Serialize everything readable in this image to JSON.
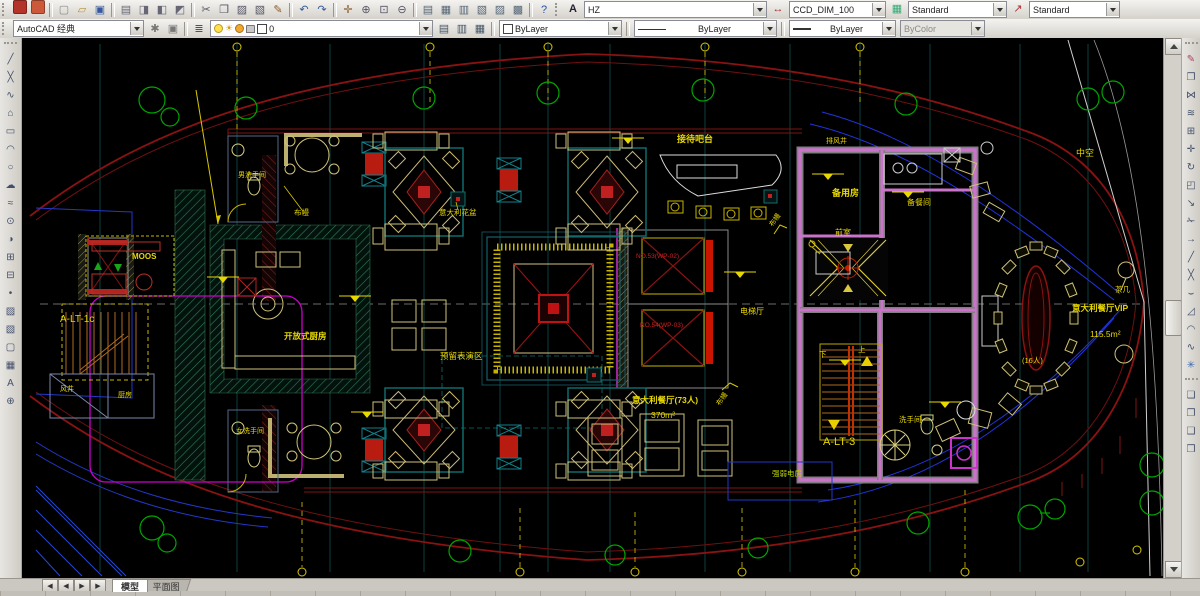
{
  "toolbars": {
    "top": {
      "pdf": [
        {
          "n": "pdf-export",
          "g": "",
          "bg": "#b5342a"
        },
        {
          "n": "pdf-review",
          "g": "",
          "bg": "#cc5a3a"
        }
      ],
      "file": [
        {
          "n": "new-file",
          "g": "▢",
          "c": "#888"
        },
        {
          "n": "open-file",
          "g": "▱",
          "c": "#b8913a"
        },
        {
          "n": "save-file",
          "g": "▣",
          "c": "#35599c"
        }
      ],
      "output": [
        {
          "n": "plot",
          "g": "▤",
          "c": "#667"
        },
        {
          "n": "plot-preview",
          "g": "◨",
          "c": "#667"
        },
        {
          "n": "publish",
          "g": "◧",
          "c": "#667"
        },
        {
          "n": "export-dwf",
          "g": "◩",
          "c": "#667"
        }
      ],
      "edit": [
        {
          "n": "cut",
          "g": "✂",
          "c": "#556"
        },
        {
          "n": "copy-clip",
          "g": "❐",
          "c": "#556"
        },
        {
          "n": "paste",
          "g": "▨",
          "c": "#556"
        },
        {
          "n": "paste-special",
          "g": "▧",
          "c": "#556"
        },
        {
          "n": "match-properties",
          "g": "✎",
          "c": "#8a5a2a"
        }
      ],
      "undo_redo": [
        {
          "n": "undo",
          "g": "↶",
          "c": "#35599c"
        },
        {
          "n": "redo",
          "g": "↷",
          "c": "#35599c"
        }
      ],
      "view": [
        {
          "n": "pan",
          "g": "✛",
          "c": "#8a5a2a"
        },
        {
          "n": "zoom-realtime",
          "g": "⊕",
          "c": "#556"
        },
        {
          "n": "zoom-window",
          "g": "⊡",
          "c": "#556"
        },
        {
          "n": "zoom-previous",
          "g": "⊖",
          "c": "#556"
        }
      ],
      "panels": [
        {
          "n": "properties-palette",
          "g": "▤",
          "c": "#567"
        },
        {
          "n": "design-center",
          "g": "▦",
          "c": "#567"
        },
        {
          "n": "tool-palettes",
          "g": "▥",
          "c": "#567"
        },
        {
          "n": "sheet-set-manager",
          "g": "▧",
          "c": "#567"
        },
        {
          "n": "markup-set-manager",
          "g": "▨",
          "c": "#567"
        },
        {
          "n": "quick-calc",
          "g": "▩",
          "c": "#567"
        }
      ],
      "help": [
        {
          "n": "help",
          "g": "?",
          "c": "#2255aa"
        }
      ],
      "text_style": {
        "icon": "A",
        "value": "HZ"
      },
      "dim_style": {
        "icon": "↔",
        "value": "CCD_DIM_100"
      },
      "table_style": {
        "icon": "▦",
        "value": "Standard"
      },
      "mleader_style": {
        "icon": "↗",
        "value": "Standard"
      }
    },
    "second": {
      "workspace_value": "AutoCAD 经典",
      "workspace_tools": [
        {
          "n": "workspace-settings",
          "g": "✱",
          "c": "#777"
        },
        {
          "n": "workspace-save",
          "g": "▣",
          "c": "#777"
        }
      ],
      "layers_button": [
        {
          "n": "layer-properties-manager",
          "g": "≣",
          "c": "#456"
        }
      ],
      "layer_value": "0",
      "layer_tools": [
        {
          "n": "layer-states",
          "g": "▤",
          "c": "#456"
        },
        {
          "n": "make-object-layer-current",
          "g": "▥",
          "c": "#456"
        },
        {
          "n": "layer-previous",
          "g": "▦",
          "c": "#456"
        }
      ],
      "color_value": "ByLayer",
      "linetype_value": "ByLayer",
      "lineweight_value": "ByLayer",
      "plot_style_value": "ByColor"
    },
    "draw": {
      "items": [
        {
          "n": "line",
          "g": "╱"
        },
        {
          "n": "construction-line",
          "g": "╳"
        },
        {
          "n": "polyline",
          "g": "∿"
        },
        {
          "n": "polygon",
          "g": "⌂"
        },
        {
          "n": "rectangle",
          "g": "▭"
        },
        {
          "n": "arc",
          "g": "◠"
        },
        {
          "n": "circle",
          "g": "○"
        },
        {
          "n": "revision-cloud",
          "g": "☁"
        },
        {
          "n": "spline",
          "g": "≈"
        },
        {
          "n": "ellipse",
          "g": "⊙"
        },
        {
          "n": "ellipse-arc",
          "g": "◑"
        },
        {
          "n": "insert-block",
          "g": "⊞"
        },
        {
          "n": "make-block",
          "g": "⊟"
        },
        {
          "n": "point",
          "g": "•"
        },
        {
          "n": "hatch",
          "g": "▨"
        },
        {
          "n": "gradient",
          "g": "▧"
        },
        {
          "n": "region",
          "g": "▢"
        },
        {
          "n": "table",
          "g": "▦"
        },
        {
          "n": "multiline-text",
          "g": "A"
        },
        {
          "n": "add-selected",
          "g": "⊕"
        }
      ]
    },
    "modify": {
      "items": [
        {
          "n": "erase",
          "g": "✎",
          "c": "#b04060"
        },
        {
          "n": "copy",
          "g": "❐"
        },
        {
          "n": "mirror",
          "g": "⋈"
        },
        {
          "n": "offset",
          "g": "≋"
        },
        {
          "n": "array",
          "g": "⊞"
        },
        {
          "n": "move",
          "g": "✛"
        },
        {
          "n": "rotate",
          "g": "↻"
        },
        {
          "n": "scale",
          "g": "◰"
        },
        {
          "n": "stretch",
          "g": "↘"
        },
        {
          "n": "trim",
          "g": "✁"
        },
        {
          "n": "extend",
          "g": "→"
        },
        {
          "n": "break-at-point",
          "g": "╱"
        },
        {
          "n": "break",
          "g": "╳"
        },
        {
          "n": "join",
          "g": "⌣"
        },
        {
          "n": "chamfer",
          "g": "◿"
        },
        {
          "n": "fillet",
          "g": "◠"
        },
        {
          "n": "blend-curves",
          "g": "∿"
        },
        {
          "n": "explode",
          "g": "✳",
          "c": "#3a6ab0"
        }
      ]
    },
    "order": {
      "items": [
        {
          "n": "bring-to-front",
          "g": "❏"
        },
        {
          "n": "send-to-back",
          "g": "❐"
        },
        {
          "n": "bring-above",
          "g": "❑"
        },
        {
          "n": "send-under",
          "g": "❒"
        }
      ]
    }
  },
  "statusbar": {
    "nav": [
      {
        "n": "first-layout",
        "g": "◀"
      },
      {
        "n": "previous-layout",
        "g": "◀"
      },
      {
        "n": "next-layout",
        "g": "▶"
      },
      {
        "n": "last-layout",
        "g": "▶"
      }
    ],
    "tabs": {
      "model": "模型",
      "layout": "平面图"
    }
  },
  "drawing": {
    "labels": {
      "reception_bar": "接待吧台",
      "exhaust_shaft": "排风井",
      "spare_room": "备用房",
      "pantry": "备餐间",
      "anteroom": "前室",
      "curtain": "布幔",
      "mens_restroom": "男洗手间",
      "italian_flowerpot": "意大利花盆",
      "open_kitchen": "开放式厨房",
      "performance_area": "预留表演区",
      "moos": "MOOS",
      "stair_1c": "A-LT-1c",
      "wind_shaft": "风井",
      "kitchen_small": "厨房",
      "elevator_1": "NO.53(WP-02)",
      "elevator_2": "NO.54(WP-03)",
      "elevator_hall": "电梯厅",
      "restaurant_seats": "意大利餐厅(73人)",
      "area_370": "370m²",
      "stair_3": "A-LT-3",
      "up": "上",
      "down": "下",
      "restroom": "洗手间",
      "electrical_room": "强弱电房",
      "womens_restroom": "女洗手间",
      "vip_room": "意大利餐厅VIP",
      "area_115": "115.5m²",
      "tea_table": "茶几",
      "seats_16": "(16人)",
      "hollow": "中空"
    }
  }
}
